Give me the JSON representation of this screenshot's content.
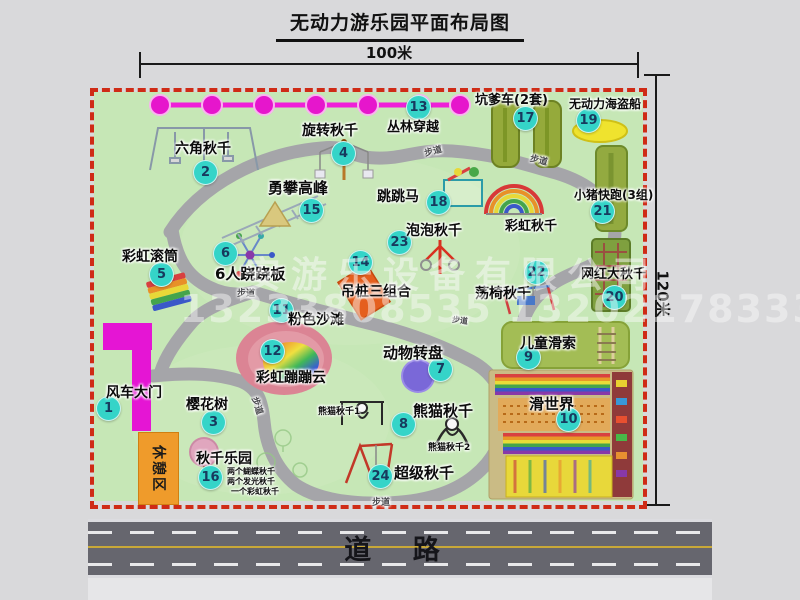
{
  "title": "无动力游乐园平面布局图",
  "dimensions": {
    "top": "100米",
    "right": "120米"
  },
  "road": {
    "label": "道 路"
  },
  "watermark": {
    "line1": "安游乐设备有限公司",
    "line2": "13233808535 13202178333"
  },
  "map": {
    "rest_area_label": "休憩区",
    "items": [
      {
        "num": "1",
        "label": "风车大门",
        "bx": 108,
        "by": 408,
        "lx": 106,
        "ly": 382,
        "ls": 14
      },
      {
        "num": "2",
        "label": "六角秋千",
        "bx": 205,
        "by": 172,
        "lx": 175,
        "ly": 138,
        "ls": 14
      },
      {
        "num": "3",
        "label": "樱花树",
        "bx": 213,
        "by": 422,
        "lx": 186,
        "ly": 394,
        "ls": 14
      },
      {
        "num": "4",
        "label": "旋转秋千",
        "bx": 343,
        "by": 153,
        "lx": 302,
        "ly": 120,
        "ls": 14
      },
      {
        "num": "5",
        "label": "彩虹滚筒",
        "bx": 161,
        "by": 274,
        "lx": 122,
        "ly": 246,
        "ls": 14
      },
      {
        "num": "6",
        "label": "6人跷跷板",
        "bx": 225,
        "by": 253,
        "lx": 215,
        "ly": 263,
        "ls": 15
      },
      {
        "num": "7",
        "label": "动物转盘",
        "bx": 440,
        "by": 369,
        "lx": 383,
        "ly": 342,
        "ls": 15
      },
      {
        "num": "8",
        "label": "熊猫秋千",
        "bx": 403,
        "by": 424,
        "lx": 413,
        "ly": 400,
        "ls": 15
      },
      {
        "num": "9",
        "label": "儿童滑索",
        "bx": 528,
        "by": 357,
        "lx": 520,
        "ly": 333,
        "ls": 14
      },
      {
        "num": "10",
        "label": "滑世界",
        "bx": 568,
        "by": 419,
        "lx": 529,
        "ly": 393,
        "ls": 15
      },
      {
        "num": "11",
        "label": "粉色沙滩",
        "bx": 281,
        "by": 310,
        "lx": 288,
        "ly": 309,
        "ls": 14
      },
      {
        "num": "12",
        "label": "彩虹蹦蹦云",
        "bx": 272,
        "by": 351,
        "lx": 256,
        "ly": 367,
        "ls": 14
      },
      {
        "num": "13",
        "label": "丛林穿越",
        "bx": 418,
        "by": 107,
        "lx": 387,
        "ly": 116,
        "ls": 13
      },
      {
        "num": "14",
        "label": "吊桩三组合",
        "bx": 360,
        "by": 262,
        "lx": 341,
        "ly": 281,
        "ls": 14
      },
      {
        "num": "15",
        "label": "勇攀高峰",
        "bx": 311,
        "by": 210,
        "lx": 268,
        "ly": 177,
        "ls": 15
      },
      {
        "num": "16",
        "label": "秋千乐园",
        "bx": 210,
        "by": 477,
        "lx": 196,
        "ly": 448,
        "ls": 14
      },
      {
        "num": "17",
        "label": "坑爹车(2套)",
        "bx": 525,
        "by": 118,
        "lx": 475,
        "ly": 89,
        "ls": 13
      },
      {
        "num": "18",
        "label": "跳跳马",
        "bx": 438,
        "by": 202,
        "lx": 377,
        "ly": 186,
        "ls": 14
      },
      {
        "num": "19",
        "label": "无动力海盗船",
        "bx": 588,
        "by": 120,
        "lx": 569,
        "ly": 95,
        "ls": 12
      },
      {
        "num": "20",
        "label": "网红大秋千",
        "bx": 614,
        "by": 297,
        "lx": 581,
        "ly": 263,
        "ls": 13
      },
      {
        "num": "21",
        "label": "小猪快跑(3组)",
        "bx": 602,
        "by": 211,
        "lx": 574,
        "ly": 186,
        "ls": 12
      },
      {
        "num": "22",
        "label": "荡椅秋千",
        "bx": 536,
        "by": 272,
        "lx": 475,
        "ly": 283,
        "ls": 14
      },
      {
        "num": "23",
        "label": "泡泡秋千",
        "bx": 399,
        "by": 242,
        "lx": 406,
        "ly": 220,
        "ls": 14
      },
      {
        "num": "24",
        "label": "超级秋千",
        "bx": 380,
        "by": 476,
        "lx": 394,
        "ly": 462,
        "ls": 15
      }
    ],
    "extra_labels": [
      {
        "text": "彩虹秋千",
        "x": 505,
        "y": 215,
        "s": 13
      },
      {
        "text": "熊猫秋千1",
        "x": 318,
        "y": 404,
        "s": 9
      },
      {
        "text": "熊猫秋千2",
        "x": 428,
        "y": 440,
        "s": 9
      },
      {
        "text": "两个蝴蝶秋千",
        "x": 227,
        "y": 466,
        "s": 8
      },
      {
        "text": "两个发光秋千",
        "x": 227,
        "y": 476,
        "s": 8
      },
      {
        "text": "一个彩虹秋千",
        "x": 231,
        "y": 486,
        "s": 8
      }
    ],
    "path_labels": [
      {
        "text": "步道",
        "x": 424,
        "y": 144,
        "rot": -14,
        "s": 9
      },
      {
        "text": "步道",
        "x": 530,
        "y": 153,
        "rot": 14,
        "s": 9
      },
      {
        "text": "步道",
        "x": 237,
        "y": 286,
        "rot": 0,
        "s": 9
      },
      {
        "text": "步道",
        "x": 452,
        "y": 315,
        "rot": 8,
        "s": 8
      },
      {
        "text": "步道",
        "x": 249,
        "y": 399,
        "rot": 72,
        "s": 9
      },
      {
        "text": "步道",
        "x": 372,
        "y": 495,
        "rot": 0,
        "s": 9
      }
    ]
  }
}
